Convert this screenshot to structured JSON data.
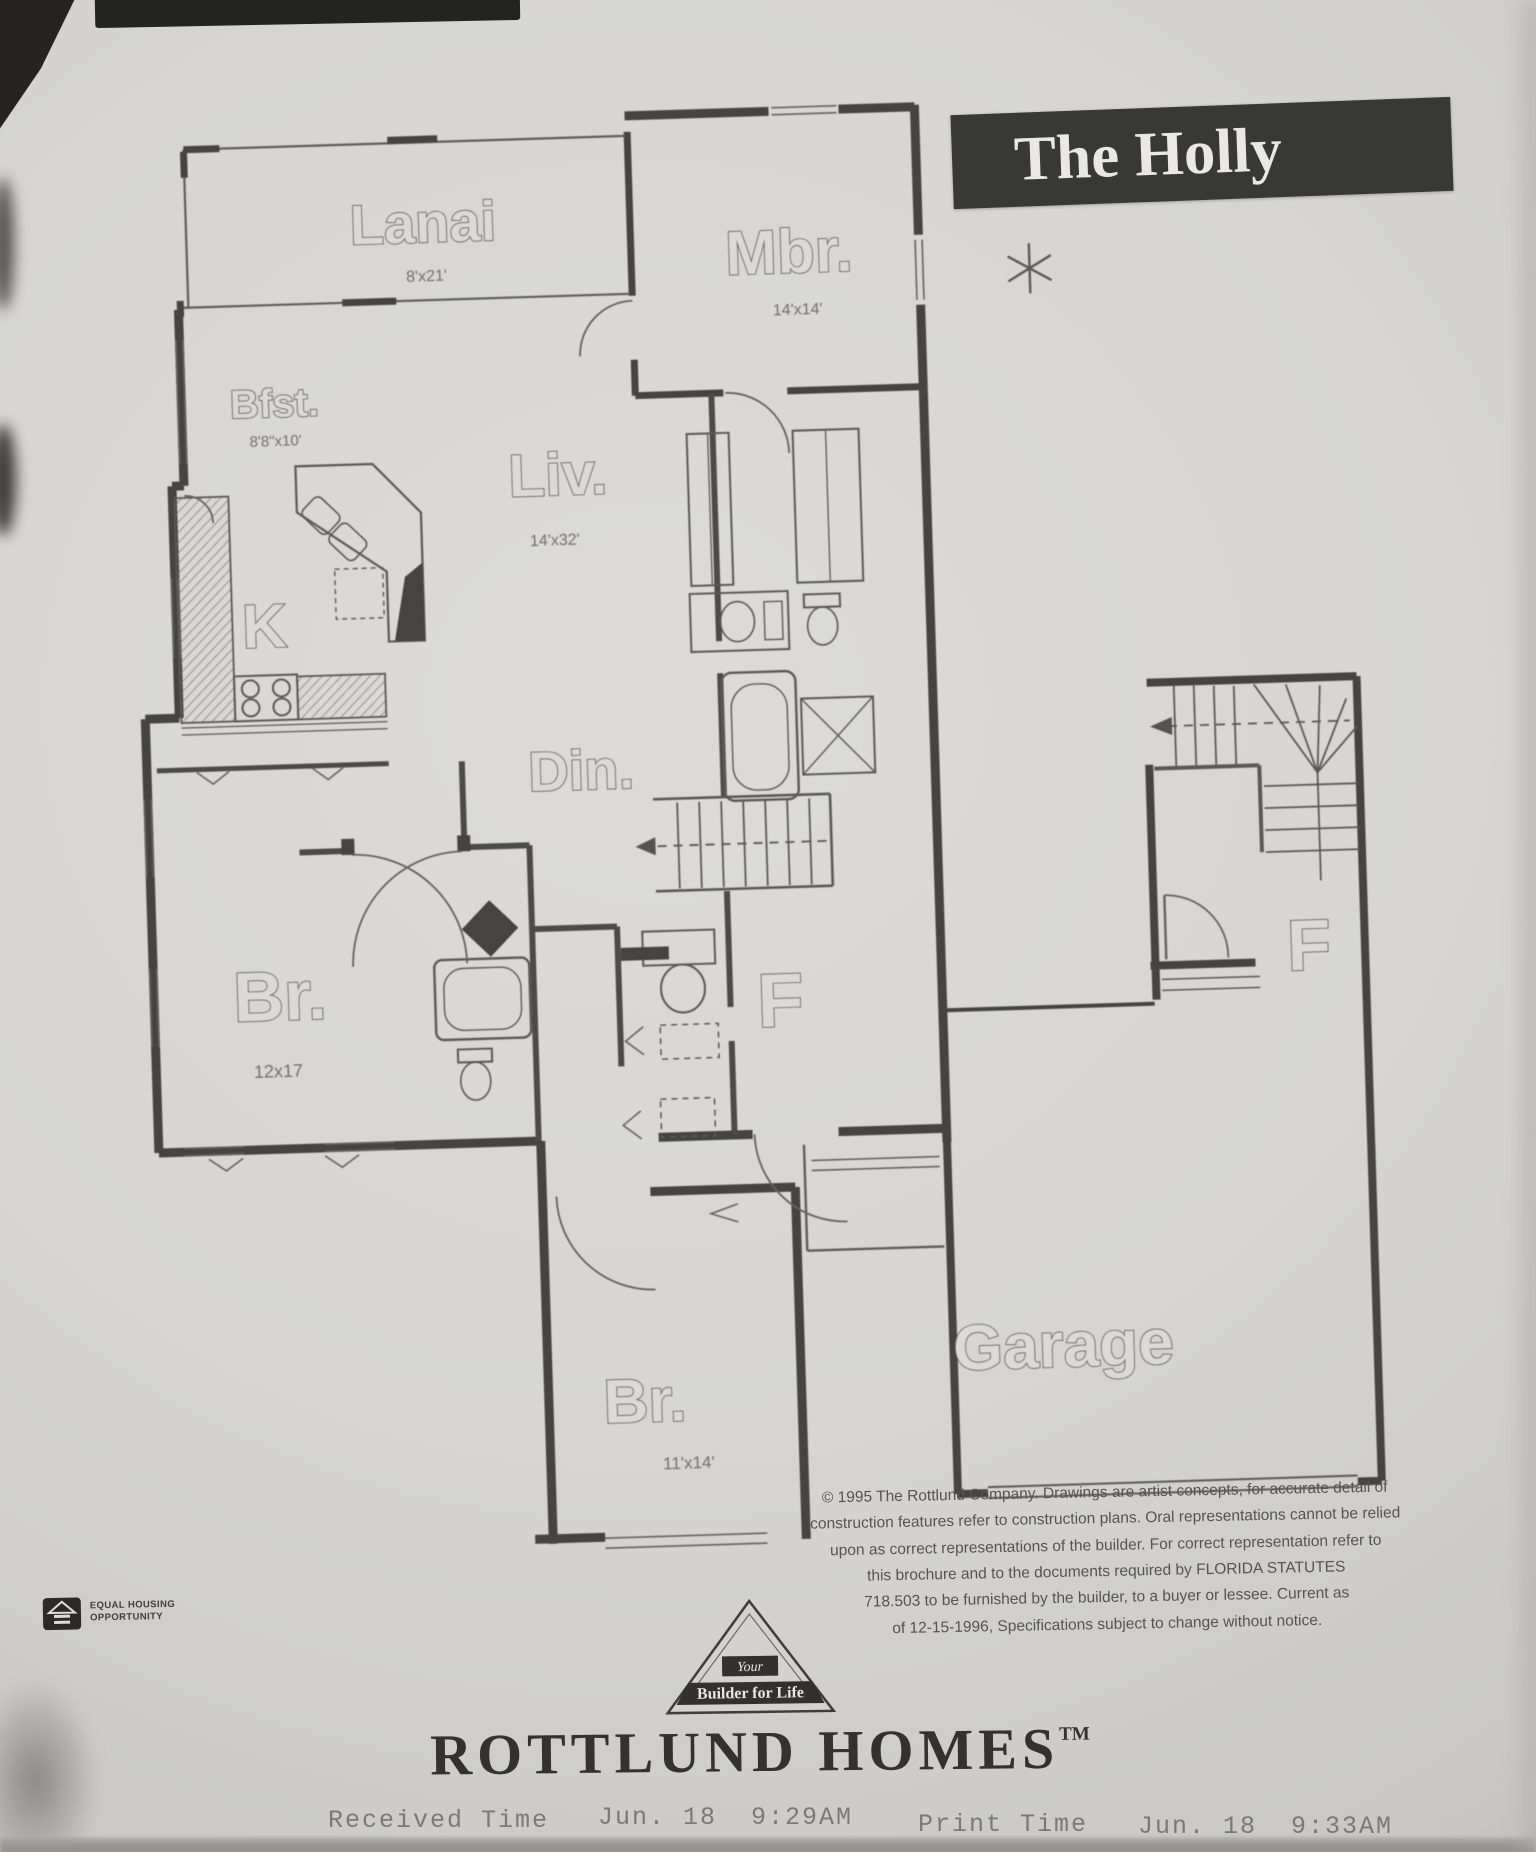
{
  "title_banner": {
    "label": "The Holly"
  },
  "plan": {
    "annotation_symbol": "asterisk",
    "rooms": [
      {
        "id": "lanai",
        "label": "Lanai",
        "dims": "8'x21'"
      },
      {
        "id": "mbr",
        "label": "Mbr.",
        "dims": "14'x14'"
      },
      {
        "id": "bfst",
        "label": "Bfst.",
        "dims": "8'8\"x10'"
      },
      {
        "id": "liv",
        "label": "Liv.",
        "dims": "14'x32'"
      },
      {
        "id": "kitchen",
        "label": "K",
        "dims": ""
      },
      {
        "id": "din",
        "label": "Din.",
        "dims": ""
      },
      {
        "id": "br1",
        "label": "Br.",
        "dims": "12x17"
      },
      {
        "id": "foyer1",
        "label": "F",
        "dims": ""
      },
      {
        "id": "br2",
        "label": "Br.",
        "dims": "11'x14'"
      },
      {
        "id": "foyer2",
        "label": "F",
        "dims": ""
      },
      {
        "id": "garage",
        "label": "Garage",
        "dims": ""
      }
    ]
  },
  "disclaimer": {
    "lines": [
      "© 1995 The Rottlund Company. Drawings are artist concepts, for accurate detail of",
      "construction features refer to construction plans. Oral representations cannot be relied",
      "upon as correct representations of the builder. For correct representation refer to",
      "this brochure and to the documents required by FLORIDA STATUTES",
      "718.503 to be furnished by the builder, to a buyer or lessee. Current as",
      "of 12-15-1996, Specifications subject to change without notice."
    ]
  },
  "equal_housing": {
    "line1": "EQUAL HOUSING",
    "line2": "OPPORTUNITY"
  },
  "builder_logo": {
    "line1": "Your",
    "line2": "Builder for Life"
  },
  "brand": {
    "name": "ROTTLUND HOMES",
    "tm": "TM"
  },
  "fax_footer": {
    "received_label": "Received Time",
    "received_value": "Jun. 18  9:29AM",
    "print_label": "Print Time",
    "print_value": "Jun. 18  9:33AM"
  }
}
